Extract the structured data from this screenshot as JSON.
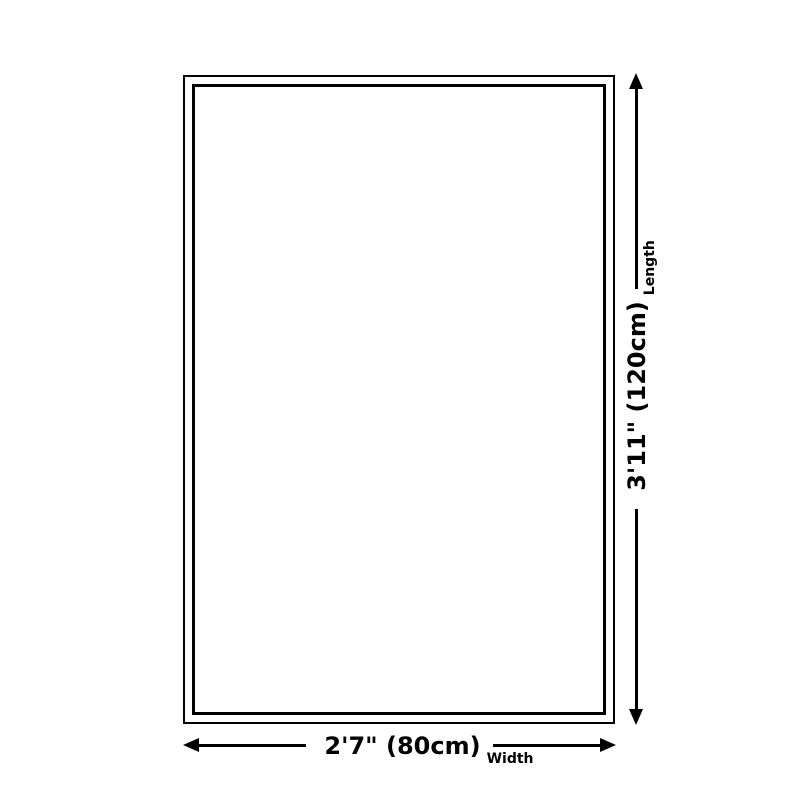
{
  "diagram": {
    "type": "product-size-diagram",
    "background_color": "#ffffff",
    "line_color": "#000000",
    "outline": {
      "style": "double-rectangle",
      "outer_border_px": 2,
      "inner_border_px": 3
    },
    "width": {
      "value": "2'7\" (80cm)",
      "label": "Width"
    },
    "length": {
      "value": "3'11\" (120cm)",
      "label": "Length"
    },
    "icons": {
      "arrow_left": "filled-triangle-left",
      "arrow_right": "filled-triangle-right",
      "arrow_up": "filled-triangle-up",
      "arrow_down": "filled-triangle-down"
    }
  }
}
